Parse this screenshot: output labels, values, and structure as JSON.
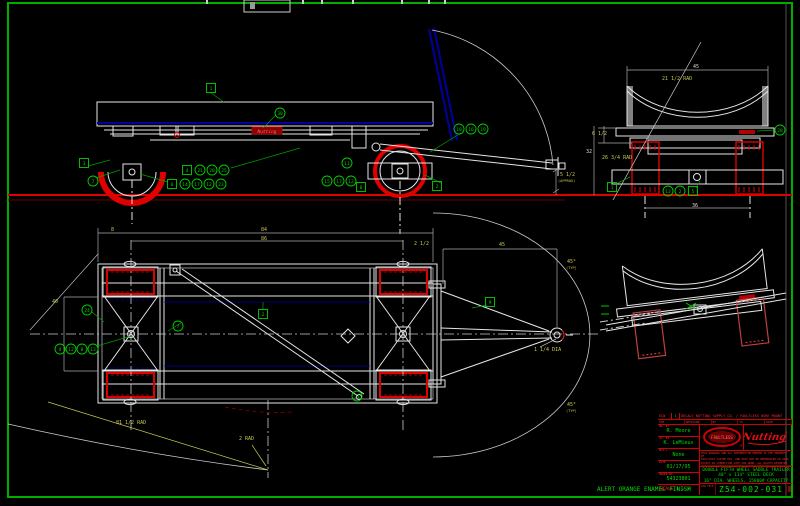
{
  "app": {
    "background": "#000000",
    "border_color": "#00ae00",
    "line_color": "#e6e6e6",
    "highlight_red": "#e00000",
    "alt_position_blue": "#0000a0",
    "dim_yellow": "#c9c94f",
    "balloon_green": "#00d000"
  },
  "notes": {
    "finish_note": "ALERT ORANGE ENAMEL FINISH"
  },
  "title_block": {
    "ecn_label": "ECN",
    "ecn_no": "1",
    "ecn_desc": "DECALS NUTTING SUPPLY CO. / FAULTLESS WIRE MOUNT",
    "rev_headers": [
      "SYM",
      "REVISION",
      "BY",
      "CK",
      "DATE"
    ],
    "fields": [
      {
        "label": "DR. BY",
        "value": "R. Moore"
      },
      {
        "label": "CH. BY",
        "value": "K. LeMieux"
      },
      {
        "label": "MAT'L",
        "value": "None"
      },
      {
        "label": "DATE",
        "value": "01/17/95"
      },
      {
        "label": "ORDER NO.",
        "value": "54323801"
      }
    ],
    "scale_label": "SCALE",
    "scale_value": "1 = 3",
    "logo_faultless": "FAULTLESS",
    "logo_nutting": "Nutting",
    "logo_reg_mark": "®",
    "fine_print_lines": [
      "THIS DRAWING AND ALL INFORMATION HEREON IS THE PROPERTY OF",
      "FAULTLESS CASTER DIV. AND MUST NOT BE REPRODUCED OR USED",
      "EXCEPT IN CONNECTION WITH OUR WORK. ALL RIGHTS RESERVED."
    ],
    "tolerance_cells": [
      "FRAC ±1/16",
      "DEC ±.01",
      "ANG ±1°",
      "FINISH"
    ],
    "title_lines": [
      "DOUBLE FIFTH WHEEL SADDLE TRAILER",
      "40\" x 114\" STEEL DECK",
      "16\" DIA. WHEELS, 15000# CAPACITY"
    ],
    "dwg_label": "CAD FILE",
    "dwg_number": "Z54-002-031"
  },
  "views": {
    "side": {
      "label": "side elevation",
      "decal_text": "Nutting"
    },
    "end": {
      "label": "end view"
    },
    "end_tilted": {
      "label": "end view tilted"
    },
    "plan": {
      "label": "plan view"
    }
  },
  "dimensions": [
    {
      "t": "5 1/2",
      "x": 560,
      "y": 176
    },
    {
      "t": "(APPROX)",
      "x": 558,
      "y": 182,
      "s": 3.6
    },
    {
      "t": "45",
      "x": 693,
      "y": 68,
      "c": "#dddddd"
    },
    {
      "t": "21 1/2 RAD",
      "x": 662,
      "y": 80
    },
    {
      "t": "6 1/2",
      "x": 592,
      "y": 135
    },
    {
      "t": "32",
      "x": 586,
      "y": 153,
      "c": "#dddddd"
    },
    {
      "t": "26 3/4 RAD",
      "x": 602,
      "y": 159
    },
    {
      "t": "36",
      "x": 692,
      "y": 207,
      "c": "#dddddd"
    },
    {
      "t": "8",
      "x": 111,
      "y": 231
    },
    {
      "t": "84",
      "x": 261,
      "y": 231
    },
    {
      "t": "86",
      "x": 261,
      "y": 240
    },
    {
      "t": "2 1/2",
      "x": 414,
      "y": 245
    },
    {
      "t": "45",
      "x": 499,
      "y": 246
    },
    {
      "t": "40",
      "x": 52,
      "y": 303
    },
    {
      "t": "1 1/4 DIA",
      "x": 534,
      "y": 351
    },
    {
      "t": "45°",
      "x": 567,
      "y": 263
    },
    {
      "t": "(TYP)",
      "x": 566,
      "y": 269,
      "s": 3.6
    },
    {
      "t": "45°",
      "x": 567,
      "y": 406
    },
    {
      "t": "(TYP)",
      "x": 566,
      "y": 412,
      "s": 3.6
    },
    {
      "t": "81 1/2 RAD",
      "x": 116,
      "y": 424
    },
    {
      "t": "2 RAD",
      "x": 239,
      "y": 440
    }
  ],
  "balloons": {
    "side": [
      {
        "s": "sq",
        "l": "1",
        "x": 211,
        "y": 88
      },
      {
        "s": "c",
        "l": "30",
        "x": 280,
        "y": 113
      },
      {
        "s": "sq",
        "l": "3",
        "x": 84,
        "y": 163
      },
      {
        "s": "c",
        "l": "7",
        "x": 93,
        "y": 181
      },
      {
        "s": "sq",
        "l": "4",
        "x": 187,
        "y": 170
      },
      {
        "s": "c",
        "l": "21",
        "x": 200,
        "y": 170
      },
      {
        "s": "c",
        "l": "20",
        "x": 212,
        "y": 170
      },
      {
        "s": "c",
        "l": "25",
        "x": 224,
        "y": 170
      },
      {
        "s": "sq",
        "l": "6",
        "x": 172,
        "y": 184
      },
      {
        "s": "c",
        "l": "14",
        "x": 185,
        "y": 184
      },
      {
        "s": "c",
        "l": "17",
        "x": 197,
        "y": 184
      },
      {
        "s": "c",
        "l": "12",
        "x": 209,
        "y": 184
      },
      {
        "s": "c",
        "l": "23",
        "x": 221,
        "y": 184
      },
      {
        "s": "c",
        "l": "10",
        "x": 459,
        "y": 129
      },
      {
        "s": "c",
        "l": "16",
        "x": 471,
        "y": 129
      },
      {
        "s": "c",
        "l": "19",
        "x": 483,
        "y": 129
      },
      {
        "s": "c",
        "l": "11",
        "x": 347,
        "y": 163
      },
      {
        "s": "c",
        "l": "15",
        "x": 327,
        "y": 181
      },
      {
        "s": "c",
        "l": "17",
        "x": 339,
        "y": 181
      },
      {
        "s": "c",
        "l": "12",
        "x": 351,
        "y": 181
      },
      {
        "s": "sq",
        "l": "8",
        "x": 361,
        "y": 187
      },
      {
        "s": "sq",
        "l": "2",
        "x": 437,
        "y": 186
      }
    ],
    "end": [
      {
        "s": "sq",
        "l": "1",
        "x": 612,
        "y": 187
      },
      {
        "s": "c",
        "l": "13",
        "x": 668,
        "y": 191
      },
      {
        "s": "c",
        "l": "2",
        "x": 680,
        "y": 191
      },
      {
        "s": "sq",
        "l": "5",
        "x": 693,
        "y": 191
      },
      {
        "s": "c",
        "l": "28",
        "x": 780,
        "y": 130
      }
    ],
    "plan": [
      {
        "s": "c",
        "l": "24",
        "x": 87,
        "y": 310
      },
      {
        "s": "c",
        "l": "4",
        "x": 60,
        "y": 349
      },
      {
        "s": "c",
        "l": "12",
        "x": 71,
        "y": 349
      },
      {
        "s": "c",
        "l": "8",
        "x": 82,
        "y": 349
      },
      {
        "s": "c",
        "l": "13",
        "x": 93,
        "y": 349
      },
      {
        "s": "c",
        "l": "7",
        "x": 178,
        "y": 326
      },
      {
        "s": "sq",
        "l": "2",
        "x": 263,
        "y": 314
      },
      {
        "s": "sq",
        "l": "9",
        "x": 490,
        "y": 302
      },
      {
        "s": "c",
        "l": "31",
        "x": 357,
        "y": 396
      }
    ]
  }
}
